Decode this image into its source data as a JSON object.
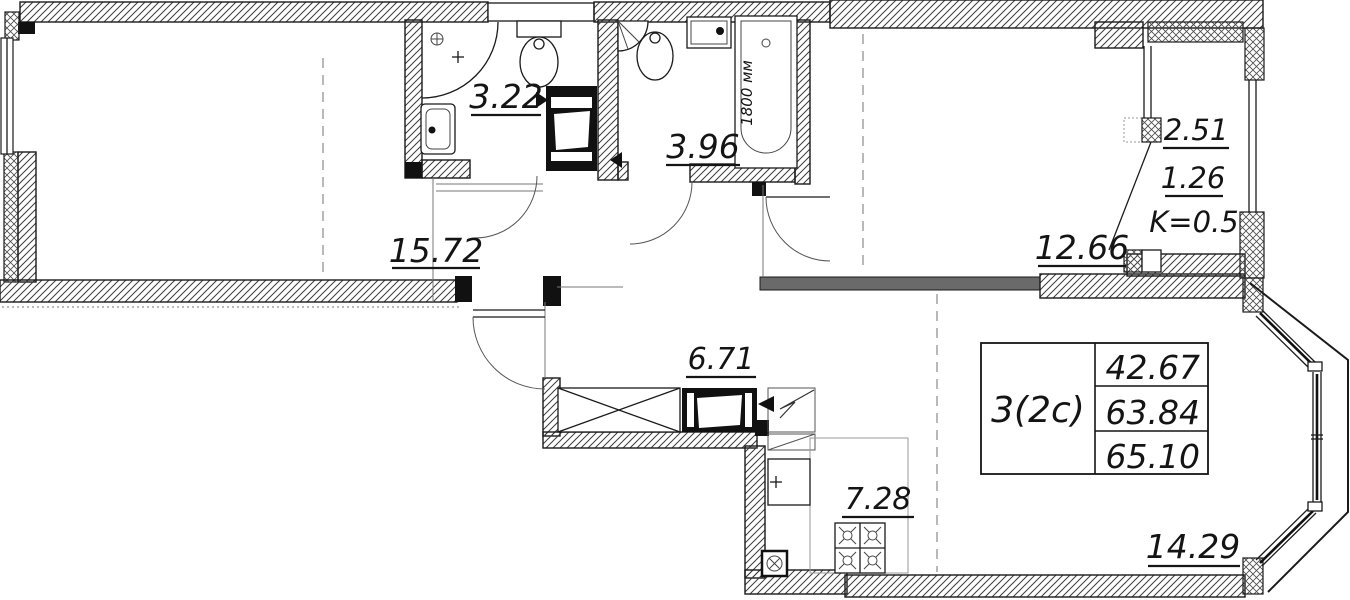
{
  "labels": {
    "bedroom_area": "15.72",
    "shower_room_area": "3.22",
    "bathroom_area": "3.96",
    "room_area": "12.66",
    "hallway_area": "6.71",
    "kitchen_area": "7.28",
    "living_room_area": "14.29",
    "balcony_area_full": "2.51",
    "balcony_area_reduced": "1.26",
    "balcony_coefficient": "K=0.5",
    "bathtub_length": "1800 мм"
  },
  "summary_table": {
    "apartment_type": "3(2c)",
    "rows": [
      "42.67",
      "63.84",
      "65.10"
    ]
  },
  "colors": {
    "ink": "#1a1a1a",
    "background": "#ffffff",
    "hatch": "#3c3c3c",
    "dash": "#8a8a8a"
  }
}
